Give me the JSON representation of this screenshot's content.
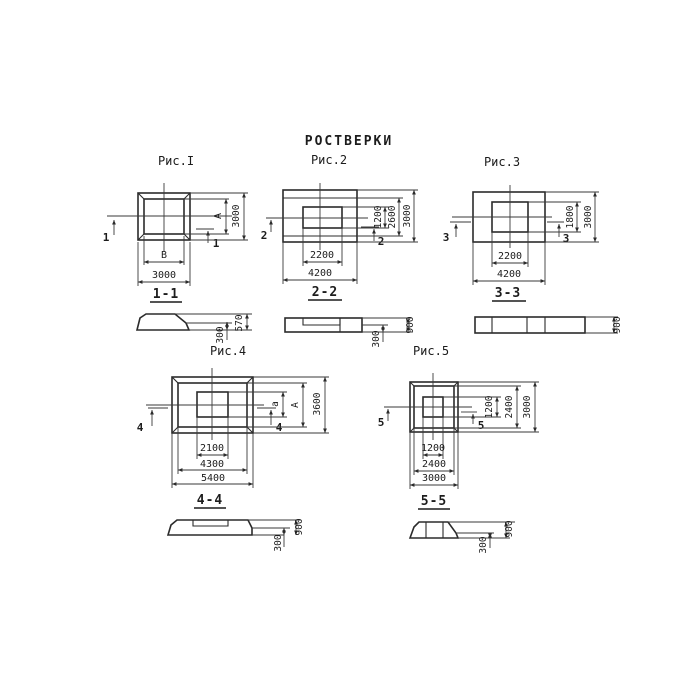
{
  "page": {
    "title": "РОСТВЕРКИ",
    "background": "#ffffff",
    "line_color": "#2b2b2b",
    "text_color": "#1c1c1c"
  },
  "figures": [
    {
      "caption": "Рис.I",
      "section_title": "1-1",
      "section_mark": "1",
      "plan_dims": {
        "bottom": [
          "В",
          "3000"
        ],
        "right": [
          "А",
          "3000"
        ]
      },
      "section_dims": [
        "300",
        "570"
      ]
    },
    {
      "caption": "Рис.2",
      "section_title": "2-2",
      "section_mark": "2",
      "plan_dims": {
        "bottom": [
          "2200",
          "4200"
        ],
        "right": [
          "1200",
          "2600",
          "3000"
        ]
      },
      "section_dims": [
        "300",
        "900"
      ]
    },
    {
      "caption": "Рис.3",
      "section_title": "3-3",
      "section_mark": "3",
      "plan_dims": {
        "bottom": [
          "2200",
          "4200"
        ],
        "right": [
          "1800",
          "3000"
        ]
      },
      "section_dims": [
        "900"
      ]
    },
    {
      "caption": "Рис.4",
      "section_title": "4-4",
      "section_mark": "4",
      "plan_dims": {
        "bottom": [
          "2100",
          "4300",
          "5400"
        ],
        "right": [
          "а",
          "А",
          "3600"
        ]
      },
      "section_dims": [
        "300",
        "900"
      ]
    },
    {
      "caption": "Рис.5",
      "section_title": "5-5",
      "section_mark": "5",
      "plan_dims": {
        "bottom": [
          "1200",
          "2400",
          "3000"
        ],
        "right": [
          "1200",
          "2400",
          "3000"
        ]
      },
      "section_dims": [
        "300",
        "900"
      ]
    }
  ]
}
